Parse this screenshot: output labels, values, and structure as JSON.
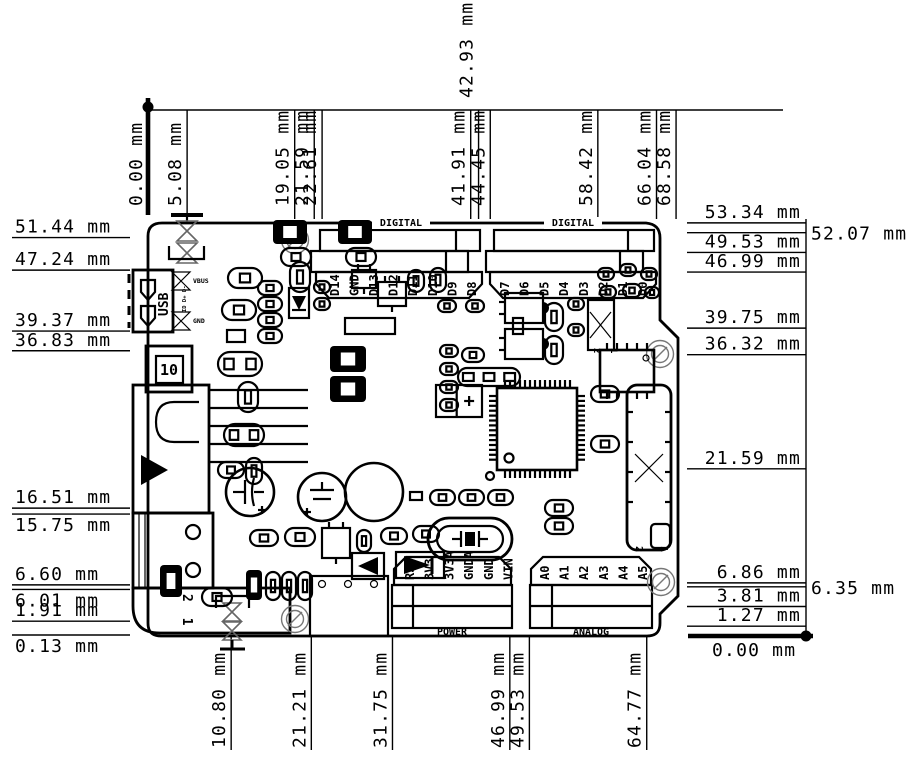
{
  "drawing": {
    "unit": "mm",
    "dimensions": {
      "top": [
        {
          "value": "0.00",
          "anchor": true
        },
        {
          "value": "5.08"
        },
        {
          "value": "19.05"
        },
        {
          "value": "21.59"
        },
        {
          "value": "22.61"
        },
        {
          "value": "41.91"
        },
        {
          "value": "42.93",
          "raised": true
        },
        {
          "value": "44.45"
        },
        {
          "value": "58.42"
        },
        {
          "value": "66.04"
        },
        {
          "value": "68.58"
        }
      ],
      "bottom": [
        {
          "value": "10.80"
        },
        {
          "value": "21.21"
        },
        {
          "value": "31.75"
        },
        {
          "value": "46.99"
        },
        {
          "value": "49.53"
        },
        {
          "value": "64.77"
        }
      ],
      "left": [
        {
          "value": "51.44"
        },
        {
          "value": "47.24"
        },
        {
          "value": "39.37"
        },
        {
          "value": "36.83"
        },
        {
          "value": "16.51"
        },
        {
          "value": "15.75",
          "below": true
        },
        {
          "value": "6.60"
        },
        {
          "value": "6.01",
          "below": true
        },
        {
          "value": "1.91"
        },
        {
          "value": "0.13",
          "below": true
        }
      ],
      "right": [
        {
          "value": "53.34"
        },
        {
          "value": "52.07",
          "side": true
        },
        {
          "value": "49.53"
        },
        {
          "value": "46.99"
        },
        {
          "value": "39.75"
        },
        {
          "value": "36.32"
        },
        {
          "value": "21.59"
        },
        {
          "value": "6.86"
        },
        {
          "value": "6.35",
          "side": true
        },
        {
          "value": "3.81"
        },
        {
          "value": "1.27"
        },
        {
          "value": "0.00",
          "anchor": true
        }
      ]
    }
  },
  "board": {
    "headers": {
      "digital_left": {
        "title": "DIGITAL",
        "pins": [
          "D14",
          "GND",
          "D13",
          "D12",
          "D11",
          "D10",
          "D9",
          "D8"
        ]
      },
      "digital_right": {
        "title": "DIGITAL",
        "pins": [
          "D7",
          "D6",
          "D5",
          "D4",
          "D3",
          "D2",
          "D1",
          "D0"
        ]
      },
      "power": {
        "title": "POWER",
        "pins": [
          "RST",
          "3V3",
          "3V3A",
          "GNDA",
          "GND",
          "VIN"
        ]
      },
      "analog": {
        "title": "ANALOG",
        "pins": [
          "A0",
          "A1",
          "A2",
          "A3",
          "A4",
          "A5"
        ]
      }
    },
    "labels": {
      "usb": "USB",
      "usb_vbus": "VBUS",
      "usb_gnd": "GND",
      "usb_data": "ID D+ D-",
      "box10": "10",
      "pin12": "2 1"
    }
  }
}
